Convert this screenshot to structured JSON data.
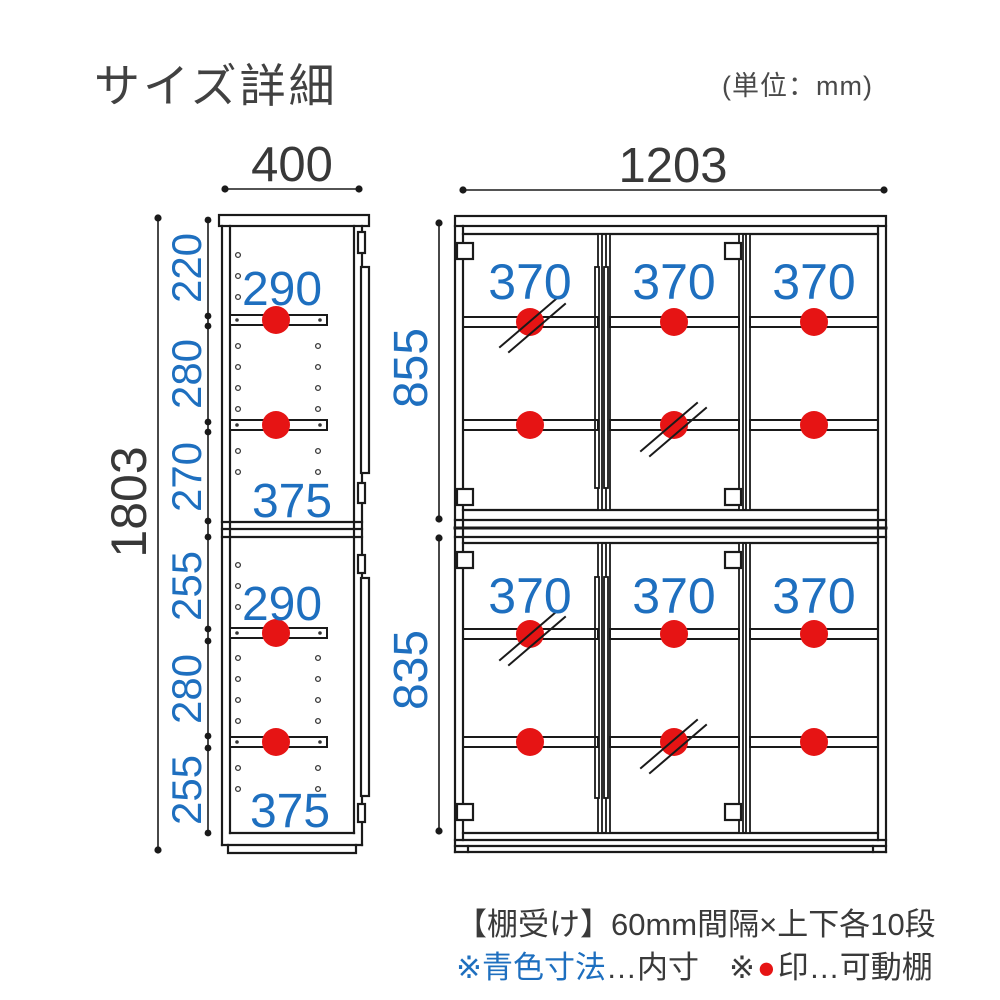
{
  "header": {
    "title": "サイズ詳細",
    "unit_note": "(単位：mm)"
  },
  "side_view": {
    "width": "400",
    "height": "1803",
    "upper": {
      "segments": [
        "220",
        "280",
        "270"
      ],
      "shelf_depth": "290",
      "bottom_depth": "375"
    },
    "lower": {
      "segments": [
        "255",
        "280",
        "255"
      ],
      "shelf_depth": "290",
      "bottom_depth": "375"
    }
  },
  "front_view": {
    "width": "1203",
    "upper": {
      "height": "855",
      "shelf_widths": [
        "370",
        "370",
        "370"
      ]
    },
    "lower": {
      "height": "835",
      "shelf_widths": [
        "370",
        "370",
        "370"
      ]
    }
  },
  "legend": {
    "shelf_support_note": "【棚受け】60mm間隔×上下各10段",
    "blue_dim_label": "※青色寸法",
    "blue_dim_meaning": "…内寸",
    "red_mark_prefix": "※",
    "red_mark_dot": "●",
    "red_mark_meaning": "印…可動棚"
  },
  "colors": {
    "dimension_blue": "#1e6fbf",
    "movable_shelf_red": "#e61414",
    "line_black": "#1a1a1a",
    "text_gray": "#3d3d3d"
  }
}
